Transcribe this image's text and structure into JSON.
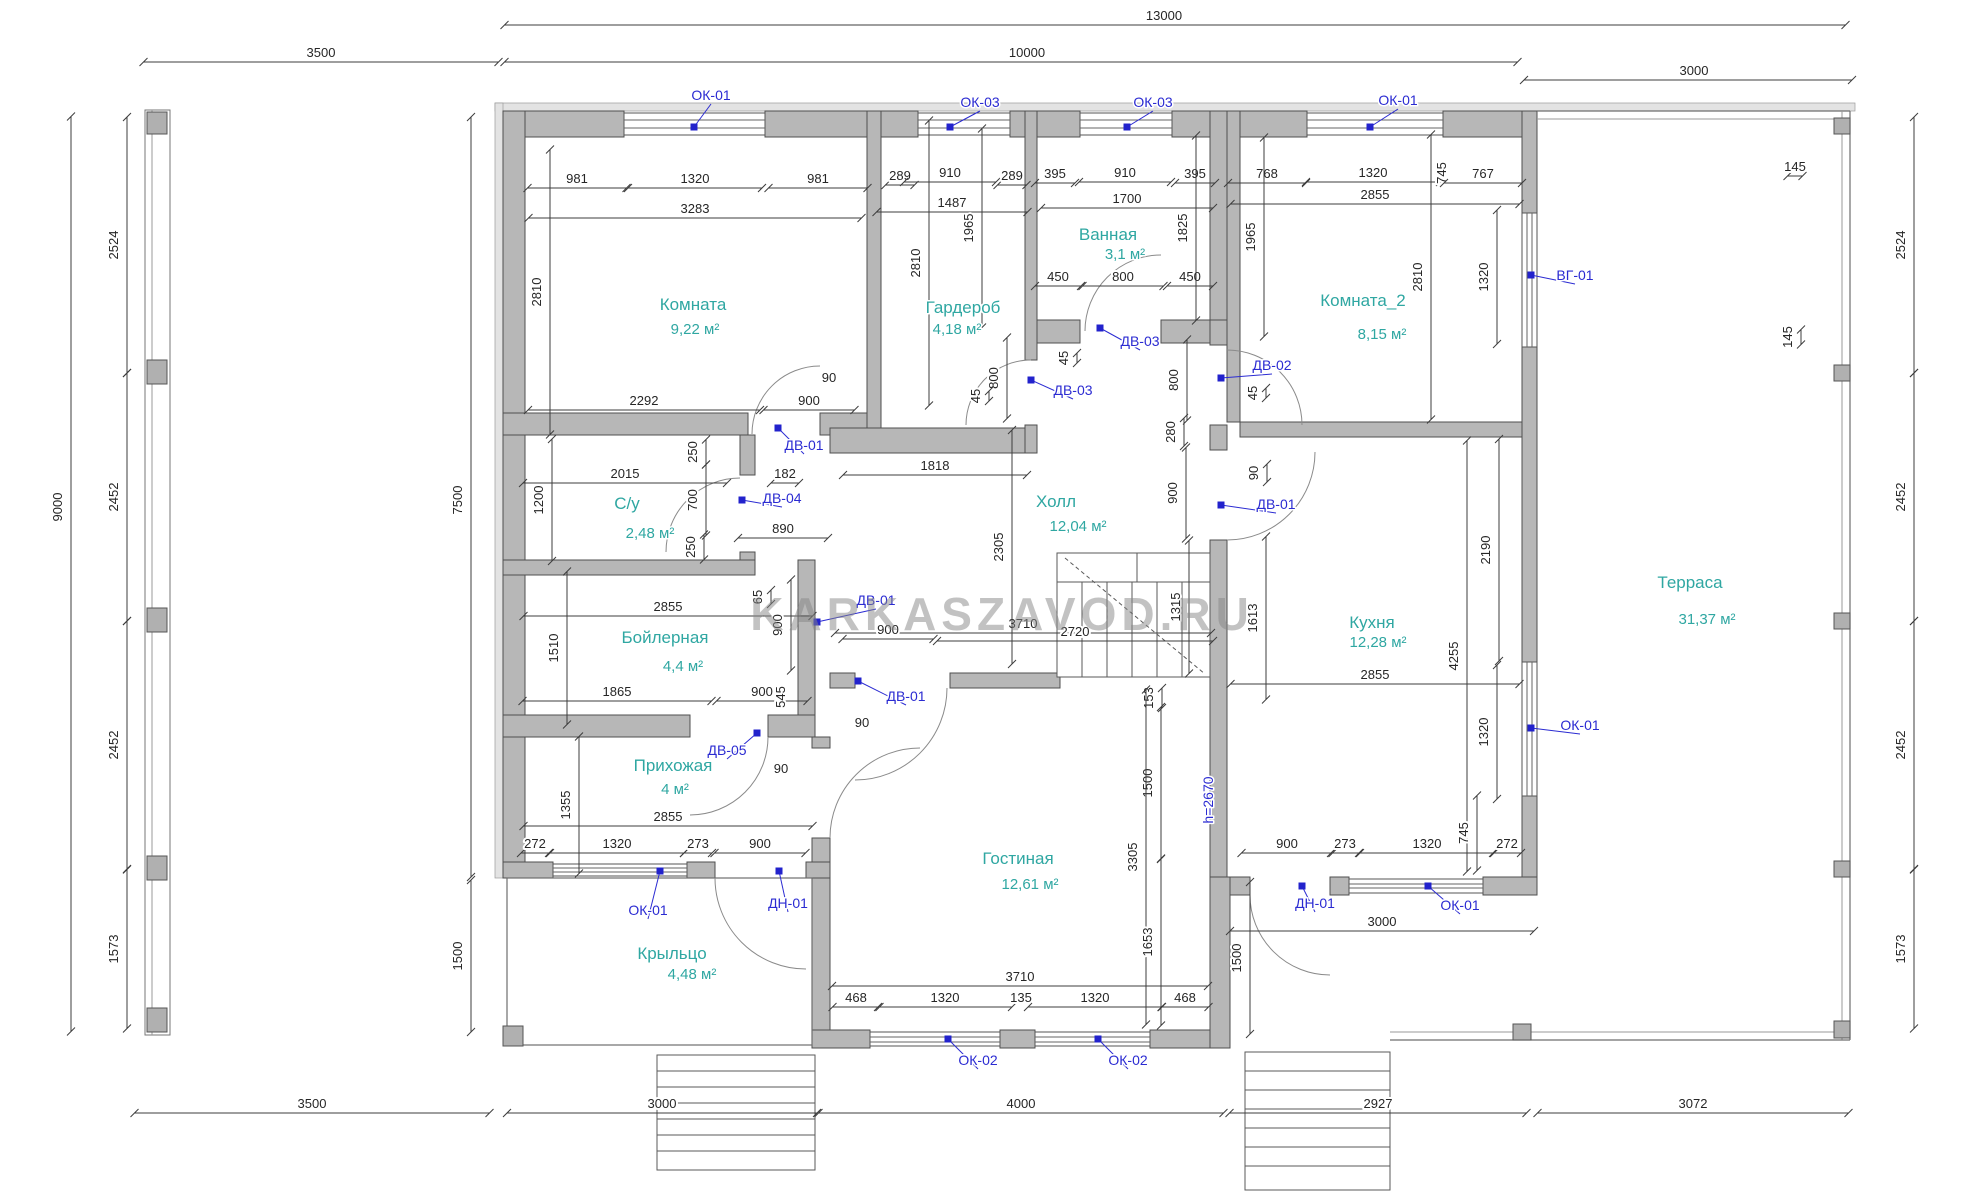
{
  "watermark": "KARKASZAVOD.RU",
  "colors": {
    "wall": "#b7b7b7",
    "room_text": "#2fa7a2",
    "marker_blue": "#2b2bd2",
    "dim_text": "#262626"
  },
  "rooms": [
    {
      "name": "Комната",
      "area": "9,22 м²",
      "nx": 693,
      "ny": 310,
      "ax": 695,
      "ay": 334
    },
    {
      "name": "Гардероб",
      "area": "4,18 м²",
      "nx": 963,
      "ny": 313,
      "ax": 957,
      "ay": 334
    },
    {
      "name": "Ванная",
      "area": "3,1 м²",
      "nx": 1108,
      "ny": 240,
      "ax": 1125,
      "ay": 259
    },
    {
      "name": "Комната_2",
      "area": "8,15 м²",
      "nx": 1363,
      "ny": 306,
      "ax": 1382,
      "ay": 339
    },
    {
      "name": "С/у",
      "area": "2,48 м²",
      "nx": 627,
      "ny": 509,
      "ax": 650,
      "ay": 538
    },
    {
      "name": "Холл",
      "area": "12,04 м²",
      "nx": 1056,
      "ny": 507,
      "ax": 1078,
      "ay": 531
    },
    {
      "name": "Бойлерная",
      "area": "4,4 м²",
      "nx": 665,
      "ny": 643,
      "ax": 683,
      "ay": 671
    },
    {
      "name": "Кухня",
      "area": "12,28 м²",
      "nx": 1372,
      "ny": 628,
      "ax": 1378,
      "ay": 647
    },
    {
      "name": "Прихожая",
      "area": "4 м²",
      "nx": 673,
      "ny": 771,
      "ax": 675,
      "ay": 794
    },
    {
      "name": "Гостиная",
      "area": "12,61 м²",
      "nx": 1018,
      "ny": 864,
      "ax": 1030,
      "ay": 889
    },
    {
      "name": "Крыльцо",
      "area": "4,48 м²",
      "nx": 672,
      "ny": 959,
      "ax": 692,
      "ay": 979
    },
    {
      "name": "Терраса",
      "area": "31,37 м²",
      "nx": 1690,
      "ny": 588,
      "ax": 1707,
      "ay": 624
    }
  ],
  "dims": [
    {
      "t": "13000",
      "x": 1164,
      "y": 20,
      "l": 1341,
      "c": 1175
    },
    {
      "t": "10000",
      "x": 1027,
      "y": 57,
      "l": 1013,
      "c": 1011
    },
    {
      "t": "3500",
      "x": 321,
      "y": 57,
      "l": 355
    },
    {
      "t": "3000",
      "x": 1694,
      "y": 75,
      "l": 328,
      "c": 1688
    },
    {
      "t": "981",
      "x": 577,
      "y": 183,
      "l": 99
    },
    {
      "t": "1320",
      "x": 695,
      "y": 183,
      "l": 134
    },
    {
      "t": "981",
      "x": 818,
      "y": 183,
      "l": 99
    },
    {
      "t": "289",
      "x": 900,
      "y": 180,
      "l": 29
    },
    {
      "t": "910",
      "x": 950,
      "y": 177,
      "l": 92
    },
    {
      "t": "289",
      "x": 1012,
      "y": 180,
      "l": 29
    },
    {
      "t": "395",
      "x": 1055,
      "y": 178,
      "l": 40
    },
    {
      "t": "910",
      "x": 1125,
      "y": 177,
      "l": 92
    },
    {
      "t": "395",
      "x": 1195,
      "y": 178,
      "l": 40
    },
    {
      "t": "768",
      "x": 1267,
      "y": 178,
      "l": 78
    },
    {
      "t": "1320",
      "x": 1373,
      "y": 177,
      "l": 134
    },
    {
      "t": "745",
      "x": 1446,
      "y": 173,
      "r": 1,
      "l": 0
    },
    {
      "t": "767",
      "x": 1483,
      "y": 178,
      "l": 78
    },
    {
      "t": "145",
      "x": 1795,
      "y": 171,
      "l": 15
    },
    {
      "t": "3283",
      "x": 695,
      "y": 213,
      "l": 333
    },
    {
      "t": "1487",
      "x": 952,
      "y": 207,
      "l": 151
    },
    {
      "t": "1700",
      "x": 1127,
      "y": 203,
      "l": 172
    },
    {
      "t": "2855",
      "x": 1375,
      "y": 199,
      "l": 289
    },
    {
      "t": "450",
      "x": 1058,
      "y": 281,
      "l": 46
    },
    {
      "t": "800",
      "x": 1123,
      "y": 281,
      "l": 81
    },
    {
      "t": "450",
      "x": 1190,
      "y": 281,
      "l": 46
    },
    {
      "t": "2292",
      "x": 644,
      "y": 405,
      "l": 232
    },
    {
      "t": "900",
      "x": 809,
      "y": 405,
      "l": 91
    },
    {
      "t": "90",
      "x": 829,
      "y": 382,
      "l": 0
    },
    {
      "t": "2015",
      "x": 625,
      "y": 478,
      "l": 204
    },
    {
      "t": "182",
      "x": 785,
      "y": 478,
      "l": 28
    },
    {
      "t": "890",
      "x": 783,
      "y": 533,
      "l": 90
    },
    {
      "t": "1818",
      "x": 935,
      "y": 470,
      "l": 184
    },
    {
      "t": "2855",
      "x": 668,
      "y": 611,
      "l": 289
    },
    {
      "t": "1865",
      "x": 617,
      "y": 696,
      "l": 189
    },
    {
      "t": "900",
      "x": 762,
      "y": 696,
      "l": 91
    },
    {
      "t": "3710",
      "x": 1023,
      "y": 628,
      "l": 376
    },
    {
      "t": "2720",
      "x": 1075,
      "y": 636,
      "l": 276
    },
    {
      "t": "900",
      "x": 888,
      "y": 634,
      "l": 91
    },
    {
      "t": "90",
      "x": 862,
      "y": 727,
      "l": 0
    },
    {
      "t": "2855",
      "x": 668,
      "y": 821,
      "l": 289
    },
    {
      "t": "272",
      "x": 535,
      "y": 848,
      "l": 28
    },
    {
      "t": "1320",
      "x": 617,
      "y": 848,
      "l": 134
    },
    {
      "t": "273",
      "x": 698,
      "y": 848,
      "l": 28
    },
    {
      "t": "900",
      "x": 760,
      "y": 848,
      "l": 91
    },
    {
      "t": "90",
      "x": 781,
      "y": 773,
      "l": 0
    },
    {
      "t": "2855",
      "x": 1375,
      "y": 679,
      "l": 289
    },
    {
      "t": "900",
      "x": 1287,
      "y": 848,
      "l": 91
    },
    {
      "t": "273",
      "x": 1345,
      "y": 848,
      "l": 28
    },
    {
      "t": "1320",
      "x": 1427,
      "y": 848,
      "l": 134
    },
    {
      "t": "272",
      "x": 1507,
      "y": 848,
      "l": 28
    },
    {
      "t": "3000",
      "x": 1382,
      "y": 926,
      "l": 304
    },
    {
      "t": "3710",
      "x": 1020,
      "y": 981,
      "l": 376
    },
    {
      "t": "468",
      "x": 856,
      "y": 1002,
      "l": 47
    },
    {
      "t": "1320",
      "x": 945,
      "y": 1002,
      "l": 134
    },
    {
      "t": "135",
      "x": 1021,
      "y": 1002,
      "l": 0
    },
    {
      "t": "1320",
      "x": 1095,
      "y": 1002,
      "l": 134
    },
    {
      "t": "468",
      "x": 1185,
      "y": 1002,
      "l": 47
    },
    {
      "t": "3500",
      "x": 312,
      "y": 1108,
      "l": 355
    },
    {
      "t": "3000",
      "x": 662,
      "y": 1108,
      "l": 310
    },
    {
      "t": "4000",
      "x": 1021,
      "y": 1108,
      "l": 405
    },
    {
      "t": "2927",
      "x": 1378,
      "y": 1108,
      "l": 297
    },
    {
      "t": "3072",
      "x": 1693,
      "y": 1108,
      "l": 311
    },
    {
      "t": "9000",
      "x": 62,
      "y": 507,
      "r": 1,
      "l": 915,
      "c": 574
    },
    {
      "t": "2524",
      "x": 118,
      "y": 245,
      "r": 1,
      "l": 256
    },
    {
      "t": "2452",
      "x": 118,
      "y": 497,
      "r": 1,
      "l": 248
    },
    {
      "t": "2452",
      "x": 118,
      "y": 745,
      "r": 1,
      "l": 248
    },
    {
      "t": "1573",
      "x": 118,
      "y": 949,
      "r": 1,
      "l": 159
    },
    {
      "t": "7500",
      "x": 462,
      "y": 500,
      "r": 1,
      "l": 760,
      "c": 497
    },
    {
      "t": "1500",
      "x": 462,
      "y": 956,
      "r": 1,
      "l": 152
    },
    {
      "t": "2810",
      "x": 541,
      "y": 292,
      "r": 1,
      "l": 285
    },
    {
      "t": "2810",
      "x": 920,
      "y": 263,
      "r": 1,
      "l": 285
    },
    {
      "t": "1965",
      "x": 973,
      "y": 228,
      "r": 1,
      "l": 199
    },
    {
      "t": "1825",
      "x": 1187,
      "y": 228,
      "r": 1,
      "l": 185
    },
    {
      "t": "1965",
      "x": 1255,
      "y": 237,
      "r": 1,
      "l": 199
    },
    {
      "t": "2810",
      "x": 1422,
      "y": 277,
      "r": 1,
      "l": 285
    },
    {
      "t": "1320",
      "x": 1488,
      "y": 277,
      "r": 1,
      "l": 134
    },
    {
      "t": "1200",
      "x": 543,
      "y": 500,
      "r": 1,
      "l": 122
    },
    {
      "t": "250",
      "x": 697,
      "y": 452,
      "r": 1,
      "l": 25
    },
    {
      "t": "700",
      "x": 697,
      "y": 500,
      "r": 1,
      "l": 71
    },
    {
      "t": "250",
      "x": 695,
      "y": 547,
      "r": 1,
      "l": 25
    },
    {
      "t": "800",
      "x": 998,
      "y": 378,
      "r": 1,
      "l": 81
    },
    {
      "t": "45",
      "x": 980,
      "y": 396,
      "r": 1,
      "l": 10
    },
    {
      "t": "45",
      "x": 1068,
      "y": 358,
      "r": 1,
      "l": 10
    },
    {
      "t": "800",
      "x": 1178,
      "y": 380,
      "r": 1,
      "l": 81
    },
    {
      "t": "45",
      "x": 1257,
      "y": 393,
      "r": 1,
      "l": 10
    },
    {
      "t": "280",
      "x": 1175,
      "y": 432,
      "r": 1,
      "l": 28
    },
    {
      "t": "900",
      "x": 1177,
      "y": 493,
      "r": 1,
      "l": 91
    },
    {
      "t": "90",
      "x": 1258,
      "y": 473,
      "r": 1,
      "l": 18
    },
    {
      "t": "2305",
      "x": 1003,
      "y": 547,
      "r": 1,
      "l": 234
    },
    {
      "t": "1315",
      "x": 1180,
      "y": 607,
      "r": 1,
      "l": 133
    },
    {
      "t": "1613",
      "x": 1257,
      "y": 618,
      "r": 1,
      "l": 163
    },
    {
      "t": "153",
      "x": 1153,
      "y": 698,
      "r": 1,
      "l": 20
    },
    {
      "t": "65",
      "x": 762,
      "y": 597,
      "r": 1,
      "l": 14
    },
    {
      "t": "900",
      "x": 782,
      "y": 625,
      "r": 1,
      "l": 91
    },
    {
      "t": "1510",
      "x": 558,
      "y": 648,
      "r": 1,
      "l": 153
    },
    {
      "t": "545",
      "x": 785,
      "y": 697,
      "r": 1,
      "l": 0
    },
    {
      "t": "1355",
      "x": 570,
      "y": 805,
      "r": 1,
      "l": 137
    },
    {
      "t": "2190",
      "x": 1490,
      "y": 550,
      "r": 1,
      "l": 222
    },
    {
      "t": "4255",
      "x": 1458,
      "y": 656,
      "r": 1,
      "l": 431
    },
    {
      "t": "1320",
      "x": 1488,
      "y": 732,
      "r": 1,
      "l": 134
    },
    {
      "t": "1500",
      "x": 1152,
      "y": 783,
      "r": 1,
      "l": 152
    },
    {
      "t": "3305",
      "x": 1137,
      "y": 857,
      "r": 1,
      "l": 335
    },
    {
      "t": "1653",
      "x": 1152,
      "y": 942,
      "r": 1,
      "l": 167
    },
    {
      "t": "1500",
      "x": 1241,
      "y": 958,
      "r": 1,
      "l": 152
    },
    {
      "t": "745",
      "x": 1468,
      "y": 833,
      "r": 1,
      "l": 75
    },
    {
      "t": "2524",
      "x": 1905,
      "y": 245,
      "r": 1,
      "l": 256
    },
    {
      "t": "2452",
      "x": 1905,
      "y": 497,
      "r": 1,
      "l": 248
    },
    {
      "t": "2452",
      "x": 1905,
      "y": 745,
      "r": 1,
      "l": 248
    },
    {
      "t": "1573",
      "x": 1905,
      "y": 949,
      "r": 1,
      "l": 159
    },
    {
      "t": "145",
      "x": 1792,
      "y": 337,
      "r": 1,
      "l": 15
    }
  ],
  "markers": [
    {
      "t": "ОК-01",
      "x": 711,
      "y": 100,
      "px": 694,
      "py": 127
    },
    {
      "t": "ОК-03",
      "x": 980,
      "y": 107,
      "px": 950,
      "py": 127
    },
    {
      "t": "ОК-03",
      "x": 1153,
      "y": 107,
      "px": 1127,
      "py": 127
    },
    {
      "t": "ОК-01",
      "x": 1398,
      "y": 105,
      "px": 1370,
      "py": 127
    },
    {
      "t": "ВГ-01",
      "x": 1575,
      "y": 280,
      "px": 1531,
      "py": 275
    },
    {
      "t": "ДВ-03",
      "x": 1140,
      "y": 346,
      "px": 1100,
      "py": 328
    },
    {
      "t": "ДВ-03",
      "x": 1073,
      "y": 395,
      "px": 1031,
      "py": 380
    },
    {
      "t": "ДВ-02",
      "x": 1272,
      "y": 370,
      "px": 1221,
      "py": 378
    },
    {
      "t": "ДВ-01",
      "x": 804,
      "y": 450,
      "px": 778,
      "py": 428
    },
    {
      "t": "ДВ-04",
      "x": 782,
      "y": 503,
      "px": 742,
      "py": 500
    },
    {
      "t": "ДВ-01",
      "x": 876,
      "y": 605,
      "px": 817,
      "py": 622
    },
    {
      "t": "ДВ-01",
      "x": 906,
      "y": 701,
      "px": 858,
      "py": 681
    },
    {
      "t": "ДВ-01",
      "x": 1276,
      "y": 509,
      "px": 1221,
      "py": 505
    },
    {
      "t": "ДВ-05",
      "x": 727,
      "y": 755,
      "px": 757,
      "py": 733
    },
    {
      "t": "ОК-01",
      "x": 648,
      "y": 915,
      "px": 660,
      "py": 871
    },
    {
      "t": "ДН-01",
      "x": 788,
      "y": 908,
      "px": 779,
      "py": 871
    },
    {
      "t": "ОК-02",
      "x": 978,
      "y": 1065,
      "px": 948,
      "py": 1039
    },
    {
      "t": "ОК-02",
      "x": 1128,
      "y": 1065,
      "px": 1098,
      "py": 1039
    },
    {
      "t": "ДН-01",
      "x": 1315,
      "y": 908,
      "px": 1302,
      "py": 886
    },
    {
      "t": "ОК-01",
      "x": 1460,
      "y": 910,
      "px": 1428,
      "py": 886
    },
    {
      "t": "ОК-01",
      "x": 1580,
      "y": 730,
      "px": 1531,
      "py": 728
    },
    {
      "t": "h=2670",
      "x": 1213,
      "y": 800,
      "r": 1
    }
  ]
}
